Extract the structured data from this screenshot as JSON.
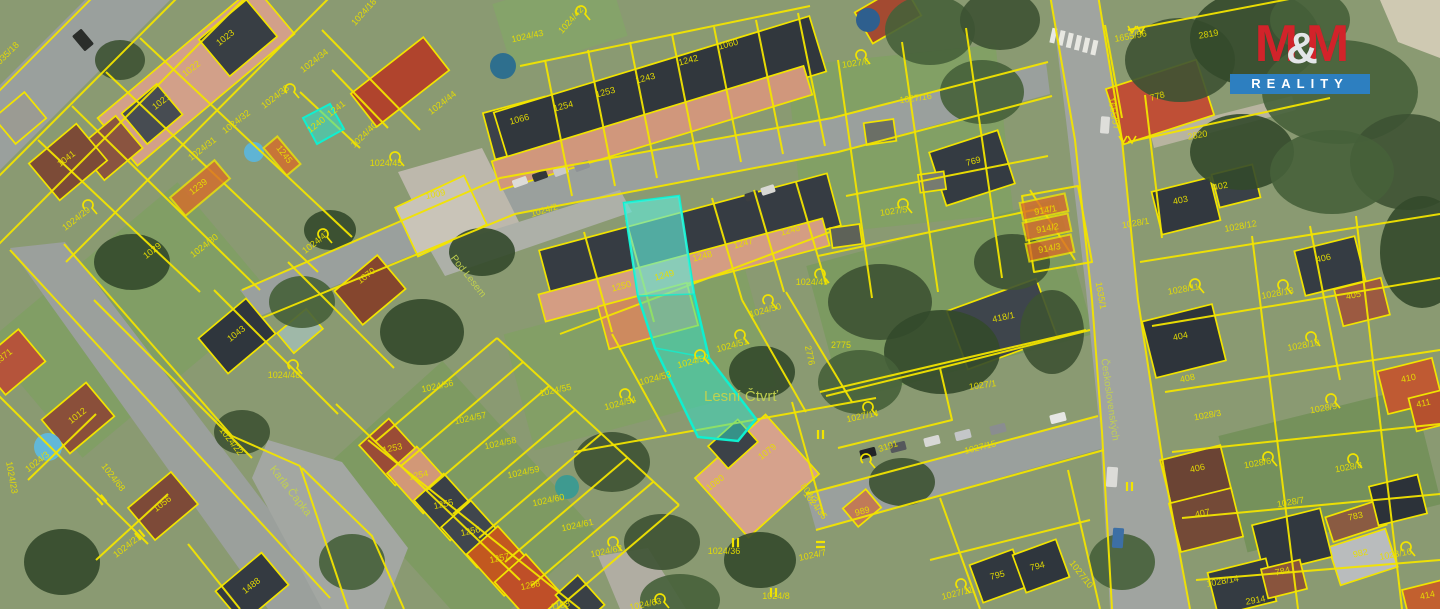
{
  "logo": {
    "m1": "M",
    "amp": "&",
    "m2": "M",
    "line2": "REALITY",
    "red": "#d2232a",
    "blue": "#2d7fc0"
  },
  "map": {
    "colors": {
      "parcel_line": "#f2e400",
      "label": "#e8df00",
      "street_label": "#c3d24e",
      "highlight_fill": "#2fe0c8",
      "highlight_stroke": "#0ff0d0",
      "highlight_orange": "#d96b28"
    },
    "highlighted_parcels": [
      "1249",
      "1024/52",
      "1240"
    ],
    "street_names": [
      "Lesní Čtvrť",
      "Karla Čapka",
      "Pod Lesem",
      "Československých"
    ],
    "labels": [
      {
        "t": "1035/18",
        "x": 8,
        "y": 57,
        "r": -45
      },
      {
        "t": "1023",
        "x": 227,
        "y": 40,
        "r": -38
      },
      {
        "t": "1022",
        "x": 193,
        "y": 71,
        "r": -38
      },
      {
        "t": "1021",
        "x": 163,
        "y": 104,
        "r": -38
      },
      {
        "t": "1041",
        "x": 68,
        "y": 161,
        "r": -38
      },
      {
        "t": "1024/34",
        "x": 316,
        "y": 63,
        "r": -38
      },
      {
        "t": "1024/33",
        "x": 277,
        "y": 99,
        "r": -38
      },
      {
        "t": "1241",
        "x": 338,
        "y": 111,
        "r": -38
      },
      {
        "t": "1240",
        "x": 318,
        "y": 127,
        "r": -38
      },
      {
        "t": "1024/32",
        "x": 238,
        "y": 124,
        "r": -38
      },
      {
        "t": "1024/31",
        "x": 204,
        "y": 151,
        "r": -38
      },
      {
        "t": "1245",
        "x": 282,
        "y": 156,
        "r": 52
      },
      {
        "t": "1239",
        "x": 200,
        "y": 189,
        "r": -38
      },
      {
        "t": "1024/29",
        "x": 78,
        "y": 221,
        "r": -38
      },
      {
        "t": "1029",
        "x": 154,
        "y": 253,
        "r": -38
      },
      {
        "t": "1024/30",
        "x": 206,
        "y": 248,
        "r": -38
      },
      {
        "t": "1024/47",
        "x": 318,
        "y": 244,
        "r": -38
      },
      {
        "t": "1070",
        "x": 368,
        "y": 278,
        "r": -38
      },
      {
        "t": "1009",
        "x": 436,
        "y": 197,
        "r": -12
      },
      {
        "t": "1024/45",
        "x": 386,
        "y": 166
      },
      {
        "t": "1024/44",
        "x": 444,
        "y": 105,
        "r": -38
      },
      {
        "t": "1024/40",
        "x": 366,
        "y": 137,
        "r": -44
      },
      {
        "t": "1024/18",
        "x": 366,
        "y": 14,
        "r": -48
      },
      {
        "t": "1024/43",
        "x": 528,
        "y": 39,
        "r": -12
      },
      {
        "t": "1024/42",
        "x": 573,
        "y": 22,
        "r": -48
      },
      {
        "t": "1066",
        "x": 520,
        "y": 122,
        "r": -15
      },
      {
        "t": "1254",
        "x": 564,
        "y": 109,
        "r": -15
      },
      {
        "t": "1253",
        "x": 606,
        "y": 95,
        "r": -15
      },
      {
        "t": "1243",
        "x": 646,
        "y": 81,
        "r": -15
      },
      {
        "t": "1242",
        "x": 689,
        "y": 63,
        "r": -15
      },
      {
        "t": "1060",
        "x": 729,
        "y": 47,
        "r": -15
      },
      {
        "t": "1024/2",
        "x": 545,
        "y": 213,
        "r": -17
      },
      {
        "t": "1250",
        "x": 622,
        "y": 289,
        "r": -15
      },
      {
        "t": "1249",
        "x": 665,
        "y": 278,
        "r": -15
      },
      {
        "t": "1248",
        "x": 703,
        "y": 259,
        "r": -15
      },
      {
        "t": "1247",
        "x": 744,
        "y": 246,
        "r": -15
      },
      {
        "t": "1246",
        "x": 791,
        "y": 233,
        "r": -15
      },
      {
        "t": "1024/50",
        "x": 766,
        "y": 313,
        "r": -15
      },
      {
        "t": "1024/51",
        "x": 733,
        "y": 348,
        "r": -15
      },
      {
        "t": "1024/52",
        "x": 694,
        "y": 364,
        "r": -15
      },
      {
        "t": "1024/53",
        "x": 656,
        "y": 381,
        "r": -15
      },
      {
        "t": "1024/54",
        "x": 621,
        "y": 406,
        "r": -15
      },
      {
        "t": "1024/55",
        "x": 556,
        "y": 393,
        "r": -12
      },
      {
        "t": "1024/56",
        "x": 438,
        "y": 389,
        "r": -12
      },
      {
        "t": "1024/57",
        "x": 471,
        "y": 421,
        "r": -12
      },
      {
        "t": "1024/58",
        "x": 501,
        "y": 446,
        "r": -12
      },
      {
        "t": "1024/59",
        "x": 524,
        "y": 475,
        "r": -12
      },
      {
        "t": "1024/60",
        "x": 549,
        "y": 503,
        "r": -12
      },
      {
        "t": "1024/61",
        "x": 578,
        "y": 528,
        "r": -12
      },
      {
        "t": "1024/62",
        "x": 607,
        "y": 554,
        "r": -12
      },
      {
        "t": "1024/63",
        "x": 646,
        "y": 607,
        "r": -12
      },
      {
        "t": "1253",
        "x": 393,
        "y": 451,
        "r": -12
      },
      {
        "t": "1254",
        "x": 419,
        "y": 478,
        "r": -12
      },
      {
        "t": "1255",
        "x": 444,
        "y": 507,
        "r": -12
      },
      {
        "t": "1256",
        "x": 471,
        "y": 534,
        "r": -12
      },
      {
        "t": "1257",
        "x": 500,
        "y": 561,
        "r": -12
      },
      {
        "t": "1258",
        "x": 531,
        "y": 588,
        "r": -12
      },
      {
        "t": "1158",
        "x": 561,
        "y": 608,
        "r": -12
      },
      {
        "t": "Lesní Čtvrť",
        "x": 741,
        "y": 401,
        "s": 15,
        "k": "street"
      },
      {
        "t": "2775",
        "x": 841,
        "y": 348
      },
      {
        "t": "2776",
        "x": 807,
        "y": 356,
        "r": 78
      },
      {
        "t": "1024/49",
        "x": 812,
        "y": 285
      },
      {
        "t": "1043",
        "x": 238,
        "y": 336,
        "r": -38
      },
      {
        "t": "1024/48",
        "x": 284,
        "y": 378
      },
      {
        "t": "1012",
        "x": 79,
        "y": 418,
        "r": -38
      },
      {
        "t": "1371",
        "x": 5,
        "y": 359,
        "r": -38
      },
      {
        "t": "1024/3",
        "x": 39,
        "y": 464,
        "r": -38
      },
      {
        "t": "1024/68",
        "x": 111,
        "y": 479,
        "r": 52
      },
      {
        "t": "1024/22",
        "x": 229,
        "y": 443,
        "r": 52
      },
      {
        "t": "Karla Čapka",
        "x": 288,
        "y": 493,
        "r": 52,
        "s": 11,
        "k": "street"
      },
      {
        "t": "1056",
        "x": 164,
        "y": 506,
        "r": -38
      },
      {
        "t": "1024/21",
        "x": 129,
        "y": 548,
        "r": -38
      },
      {
        "t": "1488",
        "x": 253,
        "y": 588,
        "r": -38
      },
      {
        "t": "1024/23",
        "x": 9,
        "y": 478,
        "r": 80
      },
      {
        "t": "Pod Lesem",
        "x": 466,
        "y": 278,
        "r": 52,
        "s": 10,
        "k": "street"
      },
      {
        "t": "1027/6",
        "x": 856,
        "y": 66,
        "r": -8
      },
      {
        "t": "1027/16",
        "x": 916,
        "y": 101,
        "r": -8
      },
      {
        "t": "1027/5",
        "x": 894,
        "y": 214,
        "r": -8
      },
      {
        "t": "769",
        "x": 974,
        "y": 164,
        "r": -15
      },
      {
        "t": "914/1",
        "x": 1046,
        "y": 213,
        "r": -10
      },
      {
        "t": "914/2",
        "x": 1048,
        "y": 231,
        "r": -10
      },
      {
        "t": "914/3",
        "x": 1050,
        "y": 251,
        "r": -10
      },
      {
        "t": "418/1",
        "x": 1004,
        "y": 320,
        "r": -12
      },
      {
        "t": "1027/1",
        "x": 983,
        "y": 388,
        "r": -8
      },
      {
        "t": "1027/14",
        "x": 863,
        "y": 419,
        "r": -12
      },
      {
        "t": "3191",
        "x": 889,
        "y": 449,
        "r": -18
      },
      {
        "t": "1027/15",
        "x": 981,
        "y": 450,
        "r": -14
      },
      {
        "t": "1079",
        "x": 769,
        "y": 454,
        "r": -38
      },
      {
        "t": "1080",
        "x": 717,
        "y": 485,
        "r": -38
      },
      {
        "t": "802/2",
        "x": 807,
        "y": 495,
        "r": 52
      },
      {
        "t": "1024/35",
        "x": 813,
        "y": 507,
        "r": 52
      },
      {
        "t": "989",
        "x": 863,
        "y": 514,
        "r": -15
      },
      {
        "t": "1024/36",
        "x": 724,
        "y": 554
      },
      {
        "t": "1024/7",
        "x": 813,
        "y": 558,
        "r": -12
      },
      {
        "t": "1024/8",
        "x": 776,
        "y": 599
      },
      {
        "t": "1027/11",
        "x": 958,
        "y": 596,
        "r": -14
      },
      {
        "t": "795",
        "x": 998,
        "y": 578,
        "r": -14
      },
      {
        "t": "794",
        "x": 1038,
        "y": 569,
        "r": -14
      },
      {
        "t": "1027/10",
        "x": 1079,
        "y": 576,
        "r": 52
      },
      {
        "t": "1655/56",
        "x": 1131,
        "y": 39,
        "r": -10
      },
      {
        "t": "2819",
        "x": 1209,
        "y": 37,
        "r": -10
      },
      {
        "t": "778",
        "x": 1158,
        "y": 99,
        "r": -15
      },
      {
        "t": "1655/57",
        "x": 1111,
        "y": 114,
        "r": 80
      },
      {
        "t": "2820",
        "x": 1198,
        "y": 138,
        "r": -10
      },
      {
        "t": "403",
        "x": 1181,
        "y": 203,
        "r": -12
      },
      {
        "t": "402",
        "x": 1221,
        "y": 189,
        "r": -12
      },
      {
        "t": "1028/1",
        "x": 1136,
        "y": 226,
        "r": -10
      },
      {
        "t": "1028/12",
        "x": 1241,
        "y": 229,
        "r": -10
      },
      {
        "t": "1028/11",
        "x": 1184,
        "y": 292,
        "r": -10
      },
      {
        "t": "1028/13",
        "x": 1278,
        "y": 296,
        "r": -10
      },
      {
        "t": "406",
        "x": 1324,
        "y": 261,
        "r": -12
      },
      {
        "t": "405",
        "x": 1354,
        "y": 298,
        "r": -12
      },
      {
        "t": "404",
        "x": 1181,
        "y": 339,
        "r": -12
      },
      {
        "t": "1028/10",
        "x": 1304,
        "y": 348,
        "r": -10
      },
      {
        "t": "408",
        "x": 1188,
        "y": 381,
        "r": -12
      },
      {
        "t": "1028/3",
        "x": 1208,
        "y": 418,
        "r": -10
      },
      {
        "t": "1028/9",
        "x": 1324,
        "y": 411,
        "r": -10
      },
      {
        "t": "410",
        "x": 1409,
        "y": 381,
        "r": -12
      },
      {
        "t": "411",
        "x": 1424,
        "y": 406,
        "r": -12
      },
      {
        "t": "1635/1",
        "x": 1098,
        "y": 296,
        "r": 80
      },
      {
        "t": "Československých",
        "x": 1107,
        "y": 400,
        "r": 82,
        "s": 10,
        "k": "street"
      },
      {
        "t": "406",
        "x": 1198,
        "y": 471,
        "r": -12
      },
      {
        "t": "1028/6",
        "x": 1258,
        "y": 466,
        "r": -10
      },
      {
        "t": "1028/8",
        "x": 1349,
        "y": 470,
        "r": -10
      },
      {
        "t": "1028/7",
        "x": 1291,
        "y": 505,
        "r": -10
      },
      {
        "t": "407",
        "x": 1203,
        "y": 516,
        "r": -12
      },
      {
        "t": "783",
        "x": 1356,
        "y": 519,
        "r": -12
      },
      {
        "t": "982",
        "x": 1361,
        "y": 556,
        "r": -12
      },
      {
        "t": "1028/16",
        "x": 1396,
        "y": 557,
        "r": -10
      },
      {
        "t": "784",
        "x": 1283,
        "y": 574,
        "r": -12
      },
      {
        "t": "1028/14",
        "x": 1223,
        "y": 584,
        "r": -10
      },
      {
        "t": "2914",
        "x": 1256,
        "y": 603,
        "r": -10
      },
      {
        "t": "414",
        "x": 1428,
        "y": 598,
        "r": -12
      }
    ]
  }
}
